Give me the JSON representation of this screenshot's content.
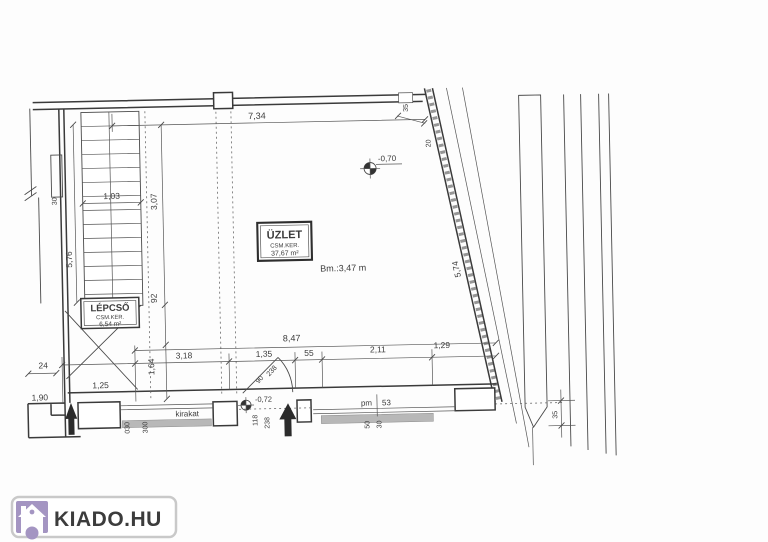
{
  "page": {
    "background": "#fdfdfd"
  },
  "watermark": {
    "text": "KIADO.HU",
    "purple": "#a495c2",
    "border": "#c9c9c9"
  },
  "plan": {
    "room": {
      "title": "ÜZLET",
      "subtitle": "CSM.KER.",
      "area": "37,67 m²"
    },
    "stairs": {
      "title": "LÉPCSŐ",
      "subtitle": "CSM.KER.",
      "area": "6,54 m²"
    },
    "ceiling_height": "Bm.:3,47 m",
    "level_marker_room": "-0,70",
    "level_marker_entry": "-0,72",
    "shop_window_label": "kirakat",
    "parapet": {
      "prefix": "pm",
      "value": "53"
    },
    "dims": {
      "top_width": "7,34",
      "stair_width": "1,03",
      "stair_run": "3,07",
      "left_height": "5,76",
      "landing": "92",
      "depth": "1,64",
      "bottom_width": "8,47",
      "seg1": "3,18",
      "seg2": "1,35",
      "seg3": "55",
      "seg4": "2,11",
      "seg5": "1,29",
      "left_small": "24",
      "left_win": "1,25",
      "left_wall": "1,90",
      "wall_thickness": "30",
      "sill_a": "030",
      "sill_b": "300",
      "door_a": "90",
      "door_b": "238",
      "door_c": "118",
      "door_d": "238",
      "win_a": "50",
      "win_b": "30",
      "right_gap": "35",
      "top_right_a": "35",
      "top_right_b": "20",
      "slant_length": "5,74"
    }
  }
}
